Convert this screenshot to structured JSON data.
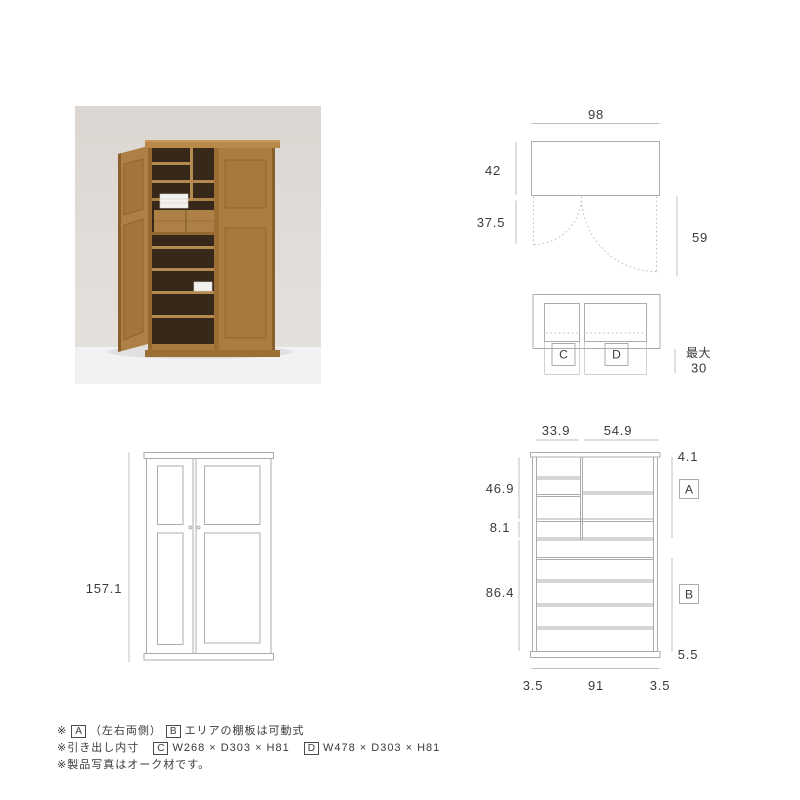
{
  "colors": {
    "cabinet_line": "#a9adb0",
    "dimension_line": "#bcbfc1",
    "text": "#3a3a3a",
    "photo_wall": "#ddd8d3",
    "photo_floor": "#f2f2f4",
    "photo_wood": "#a97c3f",
    "photo_wood_dark": "#8a5f2c",
    "photo_interior": "#38281a"
  },
  "top_view": {
    "width": "98",
    "depth": "42",
    "door_swing": "37.5",
    "open_depth": "59"
  },
  "drawer_top_view": {
    "drawer_c": "C",
    "drawer_d": "D",
    "max_label": "最大",
    "max_value": "30"
  },
  "front_view": {
    "height": "157.1"
  },
  "inner_front_view": {
    "left_width": "33.9",
    "right_width": "54.9",
    "top_thickness": "4.1",
    "upper_height": "46.9",
    "drawer_height": "8.1",
    "lower_height": "86.4",
    "base_height": "5.5",
    "left_side": "3.5",
    "inner_width": "91",
    "right_side": "3.5",
    "zone_a": "A",
    "zone_b": "B"
  },
  "notes": {
    "line1": {
      "mark": "※",
      "box_a": "A",
      "text1": "（左右両側）",
      "box_b": "B",
      "text2": "エリアの棚板は可動式"
    },
    "line2": {
      "mark": "※",
      "label": "引き出し内寸",
      "box_c": "C",
      "text_c": "W268 × D303 × H81",
      "box_d": "D",
      "text_d": "W478 × D303 × H81"
    },
    "line3": {
      "mark": "※",
      "text": "製品写真はオーク材です。"
    }
  }
}
